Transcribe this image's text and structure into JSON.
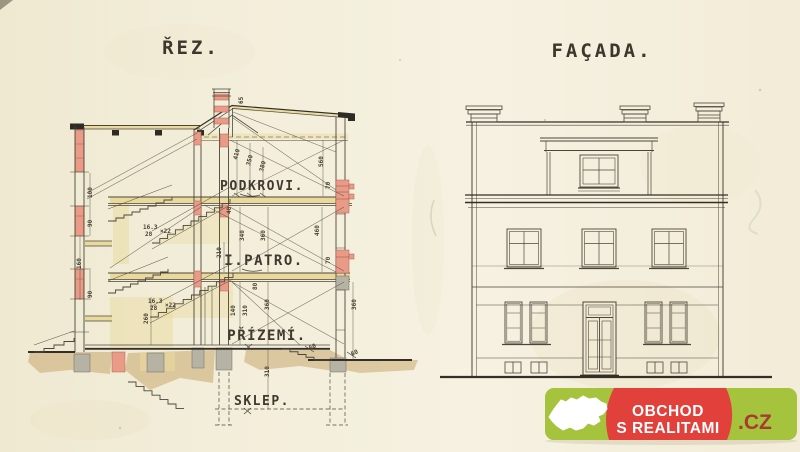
{
  "titles": {
    "section": "ŘEZ.",
    "facade": "FAÇADA."
  },
  "section": {
    "floor_labels": [
      {
        "t": "PODKROVI.",
        "x": 262,
        "y": 190,
        "s": 13
      },
      {
        "t": "I.PATRO.",
        "x": 264,
        "y": 265,
        "s": 14
      },
      {
        "t": "PŘÍZEMÍ.",
        "x": 267,
        "y": 340,
        "s": 14
      },
      {
        "t": "SKLEP.",
        "x": 262,
        "y": 405,
        "s": 13
      }
    ],
    "dims": [
      {
        "t": "410",
        "x": 237,
        "y": 160,
        "r": -75
      },
      {
        "t": "350",
        "x": 250,
        "y": 166,
        "r": -75
      },
      {
        "t": "380",
        "x": 263,
        "y": 172,
        "r": -75
      },
      {
        "t": "560",
        "x": 323,
        "y": 167,
        "r": -90
      },
      {
        "t": "65",
        "x": 243,
        "y": 104,
        "r": -90
      },
      {
        "t": "70",
        "x": 330,
        "y": 189,
        "r": -90
      },
      {
        "t": "40",
        "x": 231,
        "y": 214,
        "r": -90
      },
      {
        "t": "340",
        "x": 244,
        "y": 241,
        "r": -90
      },
      {
        "t": "360",
        "x": 265,
        "y": 241,
        "r": -90
      },
      {
        "t": "210",
        "x": 221,
        "y": 258,
        "r": -90
      },
      {
        "t": "460",
        "x": 319,
        "y": 236,
        "r": -90
      },
      {
        "t": "70",
        "x": 330,
        "y": 264,
        "r": -90
      },
      {
        "t": "80",
        "x": 257,
        "y": 290,
        "r": -90
      },
      {
        "t": "140",
        "x": 235,
        "y": 316,
        "r": -90
      },
      {
        "t": "310",
        "x": 247,
        "y": 316,
        "r": -90
      },
      {
        "t": "360",
        "x": 269,
        "y": 310,
        "r": -90
      },
      {
        "t": "360",
        "x": 356,
        "y": 310,
        "r": -90
      },
      {
        "t": "260",
        "x": 148,
        "y": 324,
        "r": -90
      },
      {
        "t": "100",
        "x": 92,
        "y": 198,
        "r": -90
      },
      {
        "t": "90",
        "x": 92,
        "y": 227,
        "r": -90
      },
      {
        "t": "160",
        "x": 81,
        "y": 269,
        "r": -90
      },
      {
        "t": "90",
        "x": 92,
        "y": 298,
        "r": -90
      },
      {
        "t": "310",
        "x": 269,
        "y": 377,
        "r": -90
      },
      {
        "t": "60",
        "x": 310,
        "y": 350,
        "r": -25
      },
      {
        "t": "60",
        "x": 352,
        "y": 356,
        "r": -25
      },
      {
        "t": "16.3",
        "x": 148,
        "y": 303,
        "r": 0
      },
      {
        "t": "28",
        "x": 150,
        "y": 310,
        "r": 0
      },
      {
        "t": "×22",
        "x": 165,
        "y": 307,
        "r": 0
      },
      {
        "t": "16.3",
        "x": 143,
        "y": 229,
        "r": 0
      },
      {
        "t": "28",
        "x": 145,
        "y": 236,
        "r": 0
      },
      {
        "t": "×22",
        "x": 160,
        "y": 233,
        "r": 0
      }
    ]
  },
  "watermark": {
    "line1": "OBCHOD",
    "line2": "S REALITAMI",
    "tld": ".CZ"
  },
  "colors": {
    "paper": "#f3eedc",
    "ink": "#4c463a",
    "red-wall": "#e99b87",
    "yellow-slab": "#e9d99c",
    "ground-tan": "#c5a265",
    "foundation-gray": "#b6b3a5",
    "logo-green": "#a6c33e",
    "logo-red": "#e2403a",
    "logo-cz": "#a83a31"
  }
}
